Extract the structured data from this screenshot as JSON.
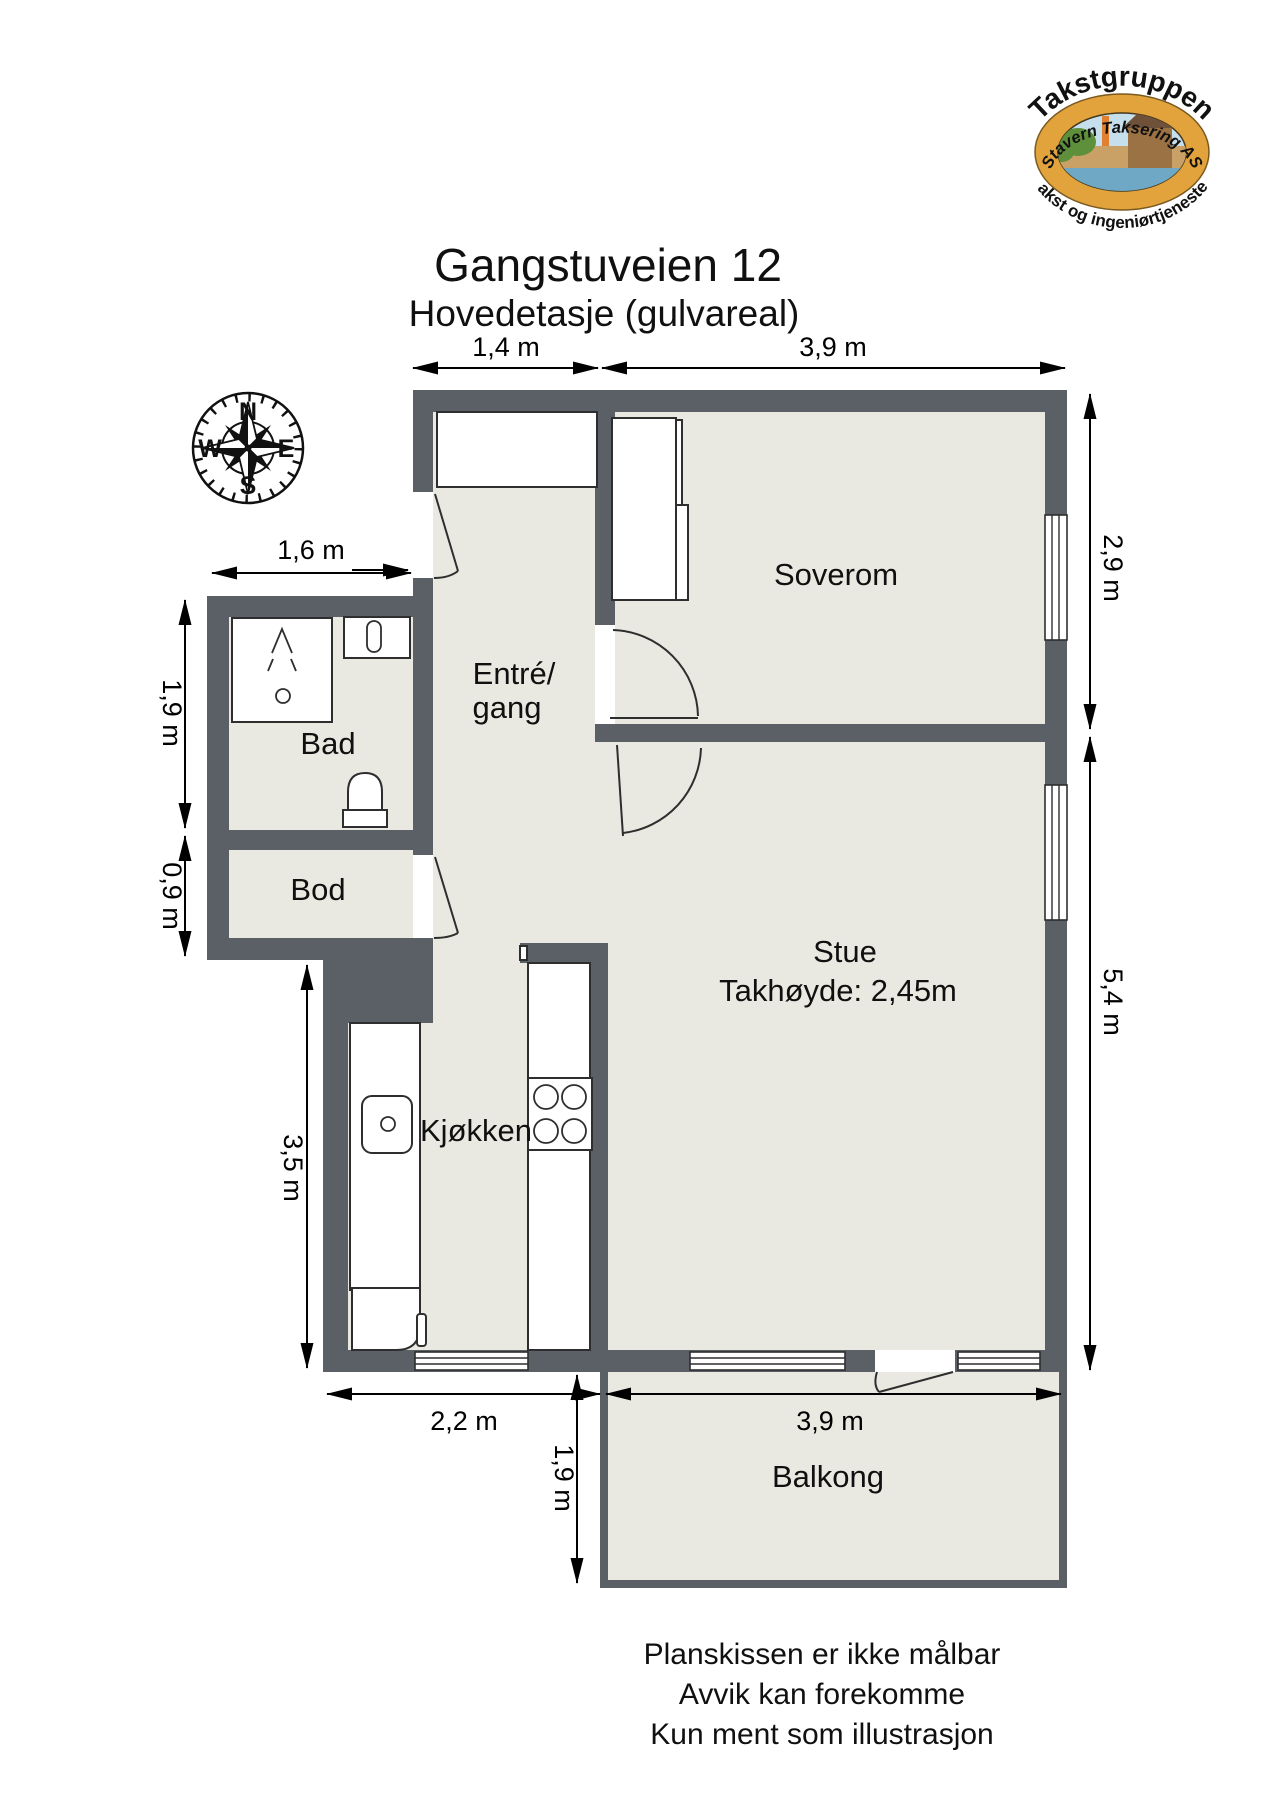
{
  "page": {
    "title": "Gangstuveien 12",
    "subtitle": "Hovedetasje (gulvareal)"
  },
  "logo": {
    "arc_top": "Takstgruppen",
    "ring": "Stavern Taksering AS",
    "arc_bottom": "Takst og ingeniørtjenester"
  },
  "compass": {
    "north": "N",
    "east": "E",
    "south": "S",
    "west": "W"
  },
  "rooms": {
    "soverom": "Soverom",
    "entre_line1": "Entré/",
    "entre_line2": "gang",
    "bad": "Bad",
    "bod": "Bod",
    "kjokken": "Kjøkken",
    "stue": "Stue",
    "stue_ceiling": "Takhøyde: 2,45m",
    "balkong": "Balkong"
  },
  "dimensions": {
    "top_entre": "1,4 m",
    "top_soverom": "3,9 m",
    "right_soverom": "2,9 m",
    "right_stue": "5,4 m",
    "bad_width": "1,6 m",
    "bad_height": "1,9 m",
    "bod_height": "0,9 m",
    "kitchen_height": "3,5 m",
    "kitchen_width": "2,2 m",
    "balcony_width": "3,9 m",
    "balcony_depth": "1,9 m"
  },
  "footer": {
    "line1": "Planskissen er ikke målbar",
    "line2": "Avvik kan forekomme",
    "line3": "Kun ment som illustrasjon"
  },
  "colors": {
    "wall": "#5a6066",
    "floor": "#eae9e1",
    "logo_ring": "#e2a33c",
    "logo_sky": "#c6dfec",
    "logo_green": "#5e8f3a",
    "logo_water": "#6fa8c4",
    "logo_sand": "#c9a066",
    "logo_brown": "#9b7244"
  }
}
